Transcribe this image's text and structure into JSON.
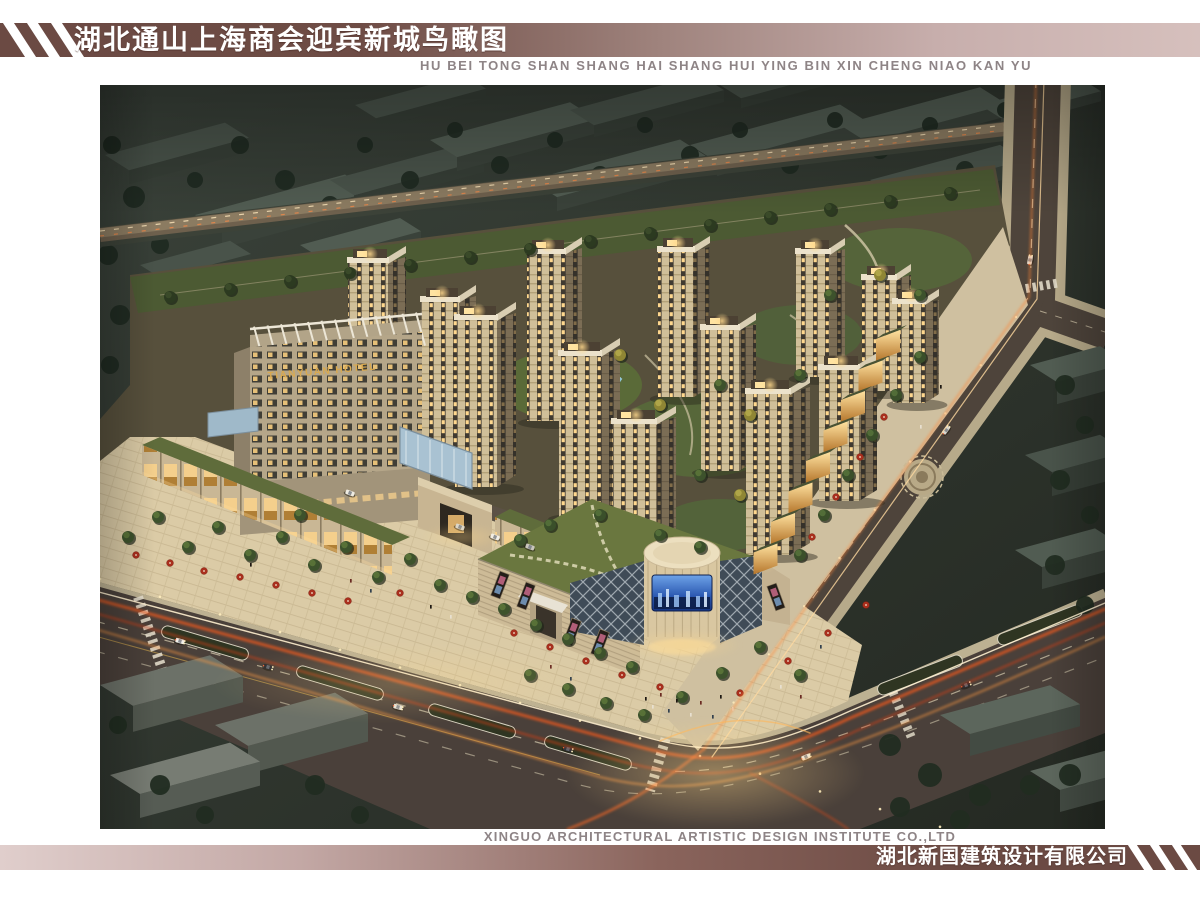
{
  "header": {
    "title": "湖北通山上海商会迎宾新城鸟瞰图",
    "subtitle_pinyin": "HU BEI TONG SHAN SHANG HAI SHANG HUI YING BIN XIN CHENG NIAO KAN YU"
  },
  "scene": {
    "hotel_sign": "TIANYUAN HOTEL"
  },
  "footer": {
    "company_en": "XINGUO ARCHITECTURAL ARTISTIC DESIGN INSTITUTE CO.,LTD",
    "company_cn": "湖北新国建筑设计有限公司"
  },
  "colors": {
    "band_dark": "#6b4a43",
    "band_light": "#d6c0bd",
    "text_gray": "#8e8486"
  }
}
